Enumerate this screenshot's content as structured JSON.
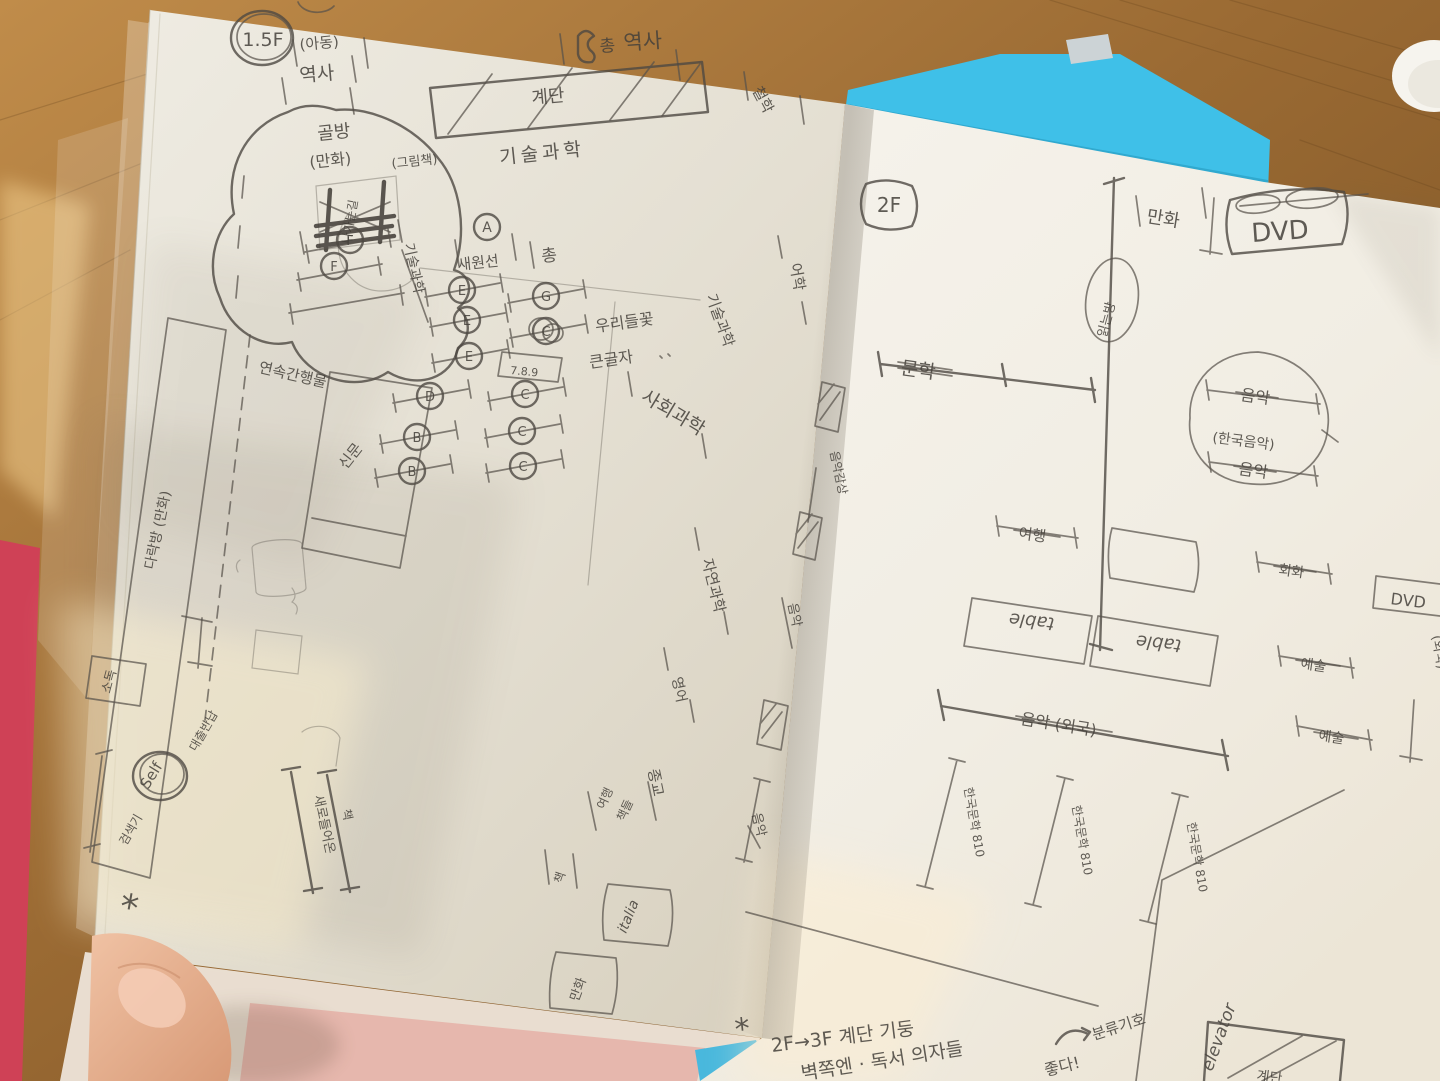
{
  "photo_meta": {
    "subject": "hand-drawn library floor plan sketches in an open notebook",
    "accent_colors": {
      "book_cover_blue": "#3fc0e8",
      "book_spine_red": "#cf4156",
      "wood": "#a0703a",
      "pencil": "#57524b"
    }
  },
  "left": {
    "floor": "1.5F",
    "kids": "(아동)",
    "kids_history": "역사",
    "hall_prefix": "총",
    "hall_history": "역사",
    "philosophy": "철학",
    "stairs": "계단",
    "tech1": "기술과학",
    "tech2": "기술과학",
    "tech3": "기술과학",
    "nook": "골방",
    "nook_comics": "(만화)",
    "nook_picture": "(그림책)",
    "nook_exit": "나가는길",
    "a_mark": "A",
    "a_label": "새원선",
    "a_side": "총",
    "letters": [
      "F",
      "F",
      "E",
      "E",
      "E",
      "D",
      "B",
      "B",
      "G",
      "C",
      "C",
      "C",
      "C"
    ],
    "shelf_note": "7.8.9",
    "flower": "우리들꽃",
    "large_print": "큰글자",
    "social": "사회과학",
    "serials": "연속간행물",
    "newspaper": "신문",
    "attic": "다락방 (만화)",
    "sanitizer": "소독",
    "language": "어학",
    "nat_science": "자연과학",
    "english": "영어",
    "religion": "종교",
    "new1": "새로들어온",
    "new2": "책",
    "self": "Self",
    "self_sub": "대출반납",
    "self_side": "검색기",
    "star": "*",
    "italia": "italia",
    "comics_box": "만화",
    "travel1": "여행",
    "travel2": "책들",
    "book_tick": "책"
  },
  "right": {
    "floor": "2F",
    "comics": "만화",
    "dvd": "DVD",
    "reading": "읽는방",
    "literature": "문학",
    "music_top": "음악",
    "music_kr": "(한국음악)",
    "music_bot": "음악",
    "travel": "여행",
    "table1": "table",
    "table2": "table",
    "painting": "회화",
    "dvd_side": "DVD",
    "art1": "예술",
    "art2": "예술",
    "foreign_edge": "(외국)",
    "music_foreign": "음악 (외국)",
    "shelf1": "한국문학 810",
    "shelf2": "한국문학 810",
    "shelf3": "한국문학 810",
    "listen": "음악감상",
    "music_v1": "음악",
    "music_v2": "음악",
    "elevator": "elevator",
    "stairs": "계단",
    "class_no": "분류기호",
    "star": "*",
    "note1": "2F→3F 계단 기둥",
    "note2": "벽쪽엔 · 독서 의자들",
    "note3": "좋다!"
  }
}
